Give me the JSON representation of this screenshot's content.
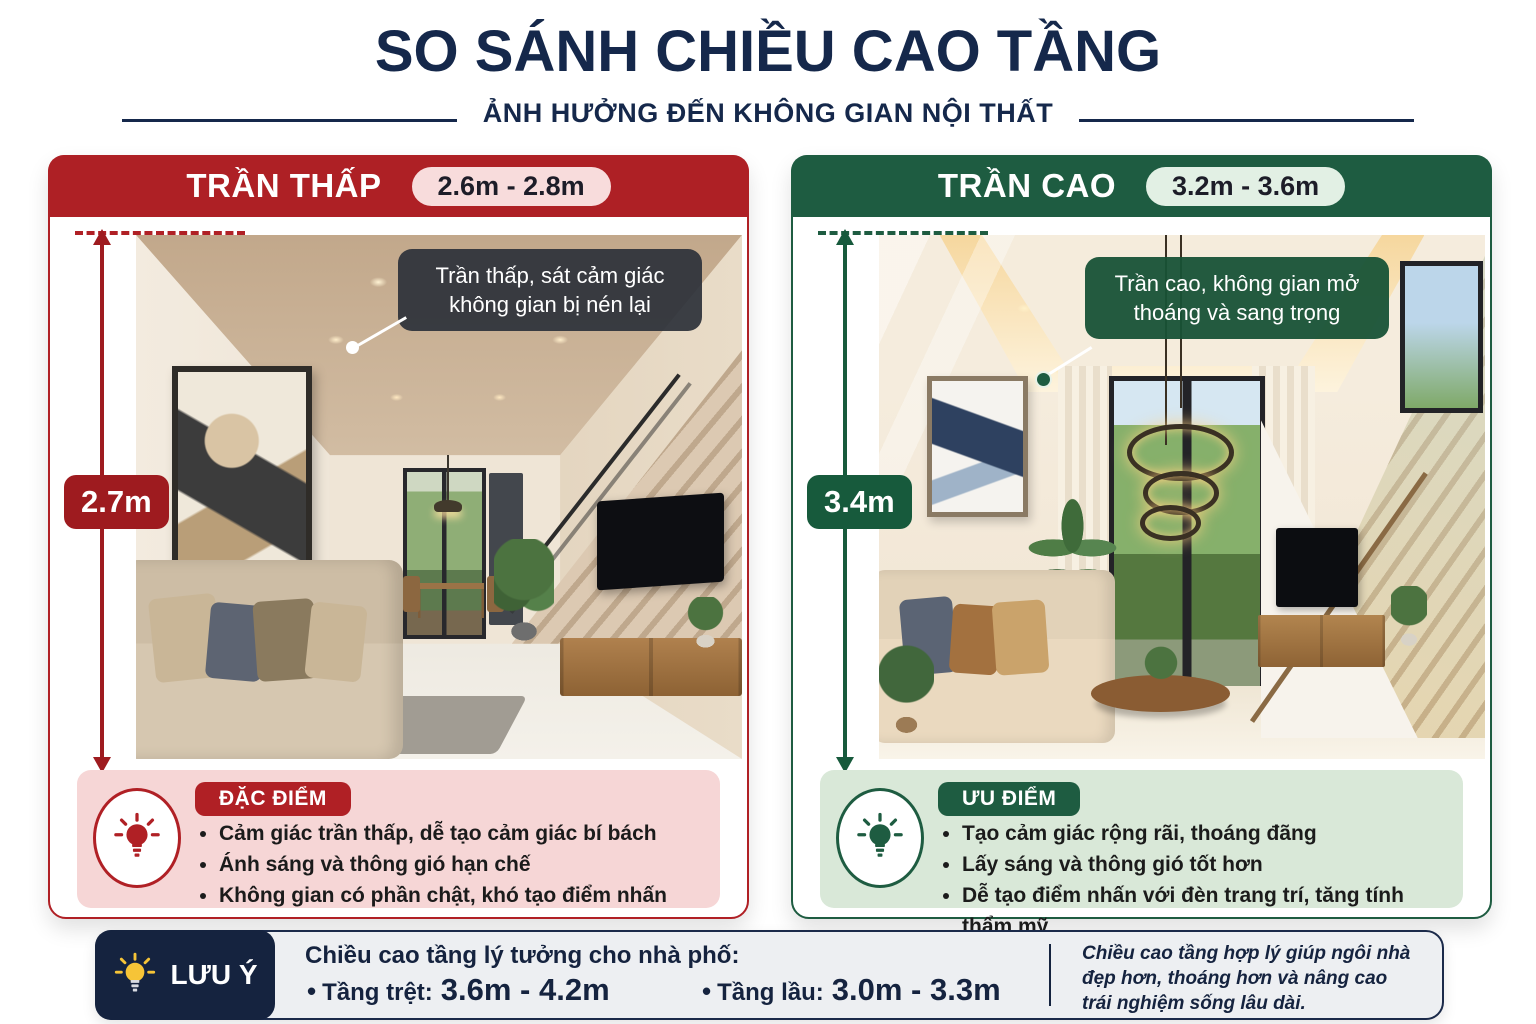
{
  "header": {
    "title": "SO SÁNH CHIỀU CAO TẦNG",
    "subtitle": "ẢNH HƯỞNG ĐẾN KHÔNG GIAN NỘI THẤT"
  },
  "panels": {
    "low": {
      "title": "TRẦN THẤP",
      "badge": "2.6m - 2.8m",
      "measurement": "2.7m",
      "callout": "Trần thấp, sát cảm giác không gian bị nén lại",
      "info_title": "ĐẶC ĐIỂM",
      "bullets": [
        "Cảm giác trần thấp, dễ tạo cảm giác bí bách",
        "Ánh sáng và thông gió hạn chế",
        "Không gian có phần chật, khó tạo điểm nhấn"
      ]
    },
    "high": {
      "title": "TRẦN CAO",
      "badge": "3.2m - 3.6m",
      "measurement": "3.4m",
      "callout": "Trần cao, không gian mở thoáng và sang trọng",
      "info_title": "ƯU ĐIỂM",
      "bullets": [
        "Tạo cảm giác rộng rãi, thoáng đãng",
        "Lấy sáng và thông gió tốt hơn",
        "Dễ tạo điểm nhấn với đèn trang trí, tăng tính thẩm mỹ"
      ]
    }
  },
  "note": {
    "label": "LƯU Ý",
    "bullet": "•",
    "heading": "Chiều cao tầng lý tưởng cho nhà phố:",
    "items": [
      {
        "label": "Tầng trệt:",
        "value": "3.6m - 4.2m"
      },
      {
        "label": "Tầng lầu:",
        "value": "3.0m - 3.3m"
      }
    ],
    "aside": "Chiều cao tầng hợp lý giúp ngôi nhà đẹp hơn, thoáng hơn và nâng cao trái nghiệm sống lâu dài."
  },
  "icons": {
    "low_info": "lightbulb-icon",
    "high_info": "lightbulb-icon",
    "note": "lightbulb-icon"
  },
  "colors": {
    "navy": "#15284b",
    "red_header": "#ae2025",
    "red_dark": "#9e1b1f",
    "pink_box": "#f6d6d6",
    "pink_badge": "#f8dcdc",
    "green_header": "#1e5c41",
    "green_dark": "#175a3c",
    "green_box": "#d9e8d8",
    "green_badge": "#e2f0e4",
    "note_navy": "#15233f",
    "bulb_yellow": "#f6c437"
  }
}
